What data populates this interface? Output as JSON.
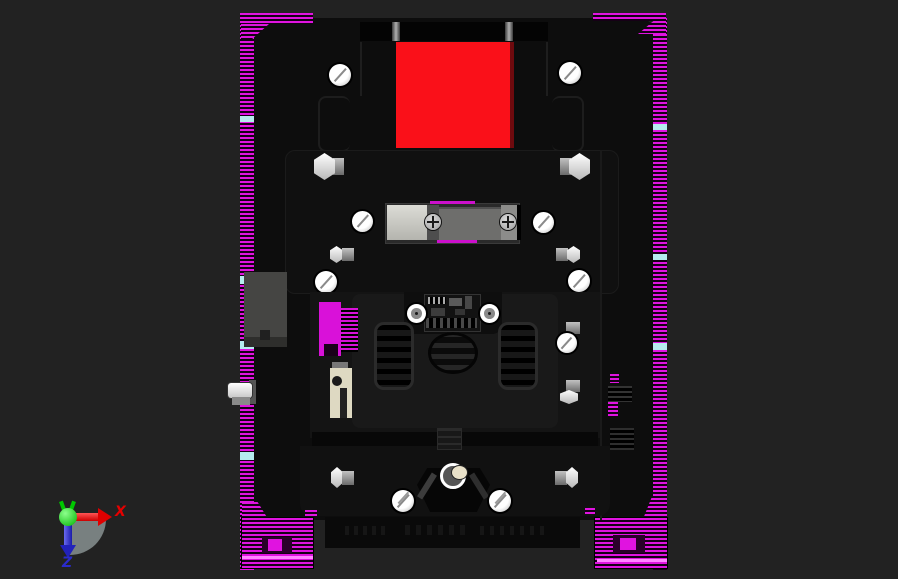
{
  "viewport": {
    "background_top_color": "#00feff",
    "background_bottom_color": "#cdddE0"
  },
  "triad": {
    "x_label": "X",
    "z_label": "Z",
    "x_axis_color": "#e60000",
    "y_axis_color": "#00d400",
    "z_axis_color": "#2a2acc"
  },
  "model": {
    "track_color": "#e013e0",
    "body_color": "#0d0d0d",
    "top_lid_color": "#fa1019",
    "accent_magenta": "#cc10cc",
    "connector_block_light": "#cfcfc9",
    "connector_block_gray": "#6e6e6c"
  }
}
